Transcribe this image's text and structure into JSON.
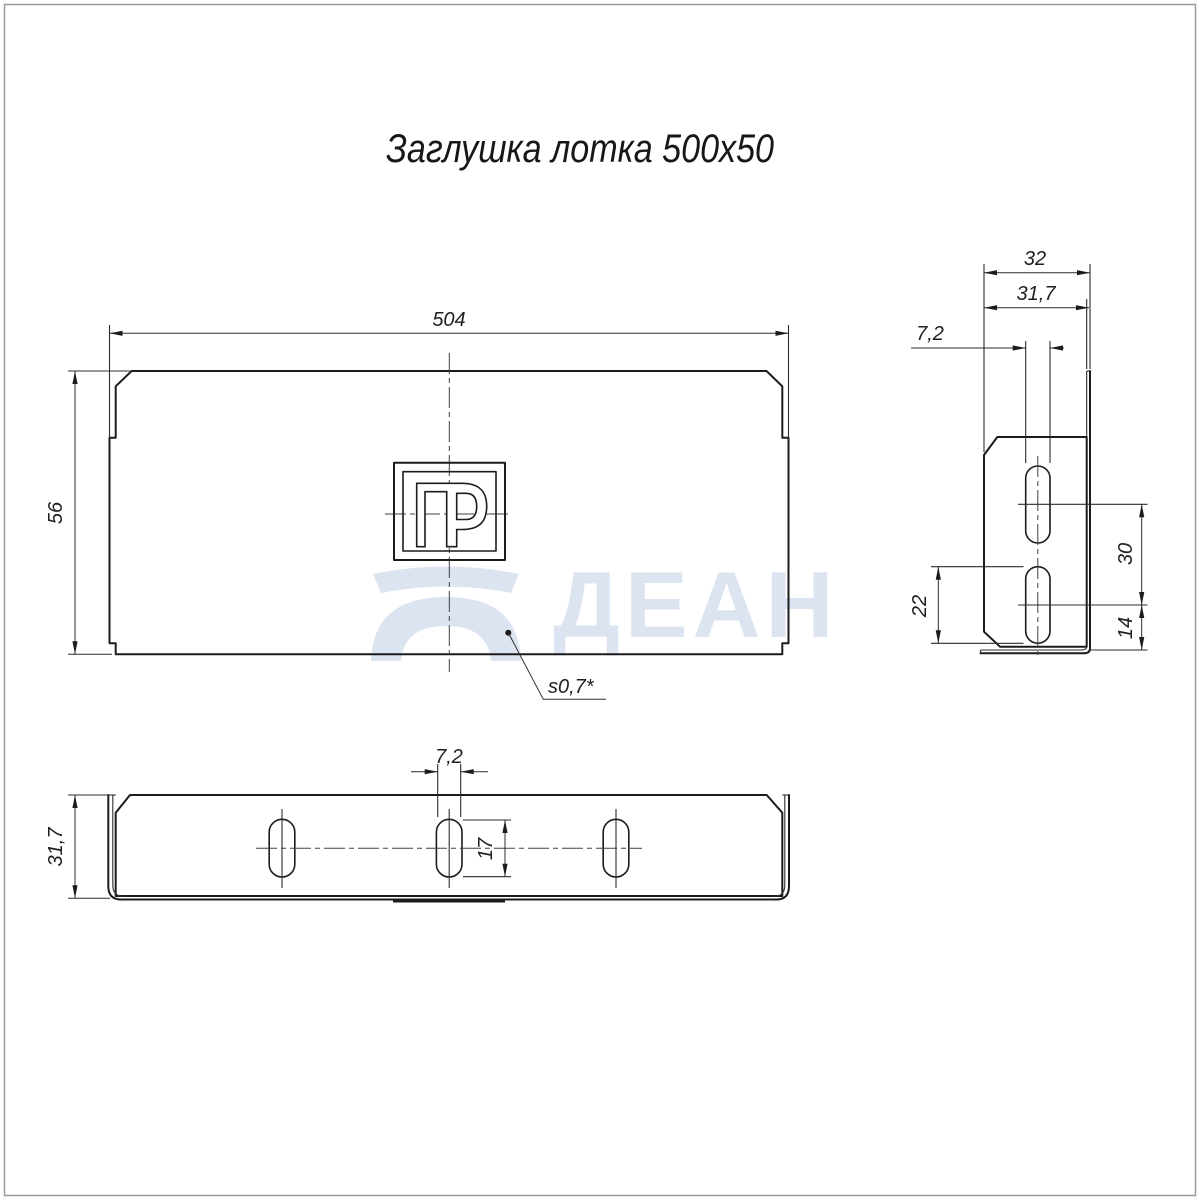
{
  "page": {
    "title": "Заглушка лотка 500х50"
  },
  "watermark": {
    "text": "ДЕАН",
    "color": "#dbe4f0"
  },
  "front_view": {
    "dim_width": "504",
    "dim_height": "56",
    "thickness_label": "s0,7*",
    "logo_text": "ПР"
  },
  "side_view": {
    "dim_depth_outer": "32",
    "dim_depth_inner": "31,7",
    "dim_slot_width": "7,2",
    "dim_slot_length": "22",
    "dim_slot_pitch": "30",
    "dim_slot_to_bottom": "14"
  },
  "bottom_view": {
    "dim_depth": "31,7",
    "dim_slot_width": "7,2",
    "dim_slot_length": "17"
  },
  "colors": {
    "line": "#1c1c1c",
    "watermark": "#dbe4f0",
    "page_border": "#9b9b9b"
  }
}
